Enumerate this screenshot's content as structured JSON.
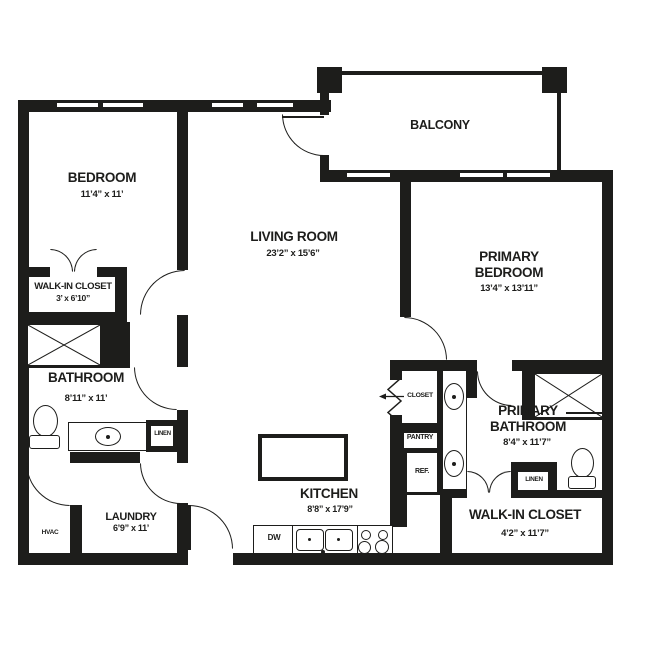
{
  "title": "Two-bedroom apartment floor plan",
  "colors": {
    "wall": "#1d1d1b",
    "background": "#ffffff"
  },
  "rooms": {
    "bedroom": {
      "name": "BEDROOM",
      "dims": "11’4” x 11’"
    },
    "bedroom_closet": {
      "name": "WALK-IN CLOSET",
      "dims": "3’ x 6’10”"
    },
    "bathroom": {
      "name": "BATHROOM",
      "dims": "8’11” x 11’"
    },
    "living_room": {
      "name": "LIVING ROOM",
      "dims": "23’2” x 15’6”"
    },
    "balcony": {
      "name": "BALCONY"
    },
    "kitchen": {
      "name": "KITCHEN",
      "dims": "8’8” x 17’9”"
    },
    "laundry": {
      "name": "LAUNDRY",
      "dims": "6’9” x 11’"
    },
    "primary_bedroom": {
      "name": "PRIMARY BEDROOM",
      "dims": "13’4” x 13’11”"
    },
    "primary_bathroom": {
      "name": "PRIMARY BATHROOM",
      "dims": "8’4” x 11’7”"
    },
    "primary_closet": {
      "name": "WALK-IN CLOSET",
      "dims": "4’2” x 11’7”"
    }
  },
  "fixtures": {
    "closet": "CLOSET",
    "pantry": "PANTRY",
    "refrigerator": "REF.",
    "linen_bath": "LINEN",
    "linen_primary": "LINEN",
    "hvac": "HVAC",
    "dishwasher": "DW"
  }
}
